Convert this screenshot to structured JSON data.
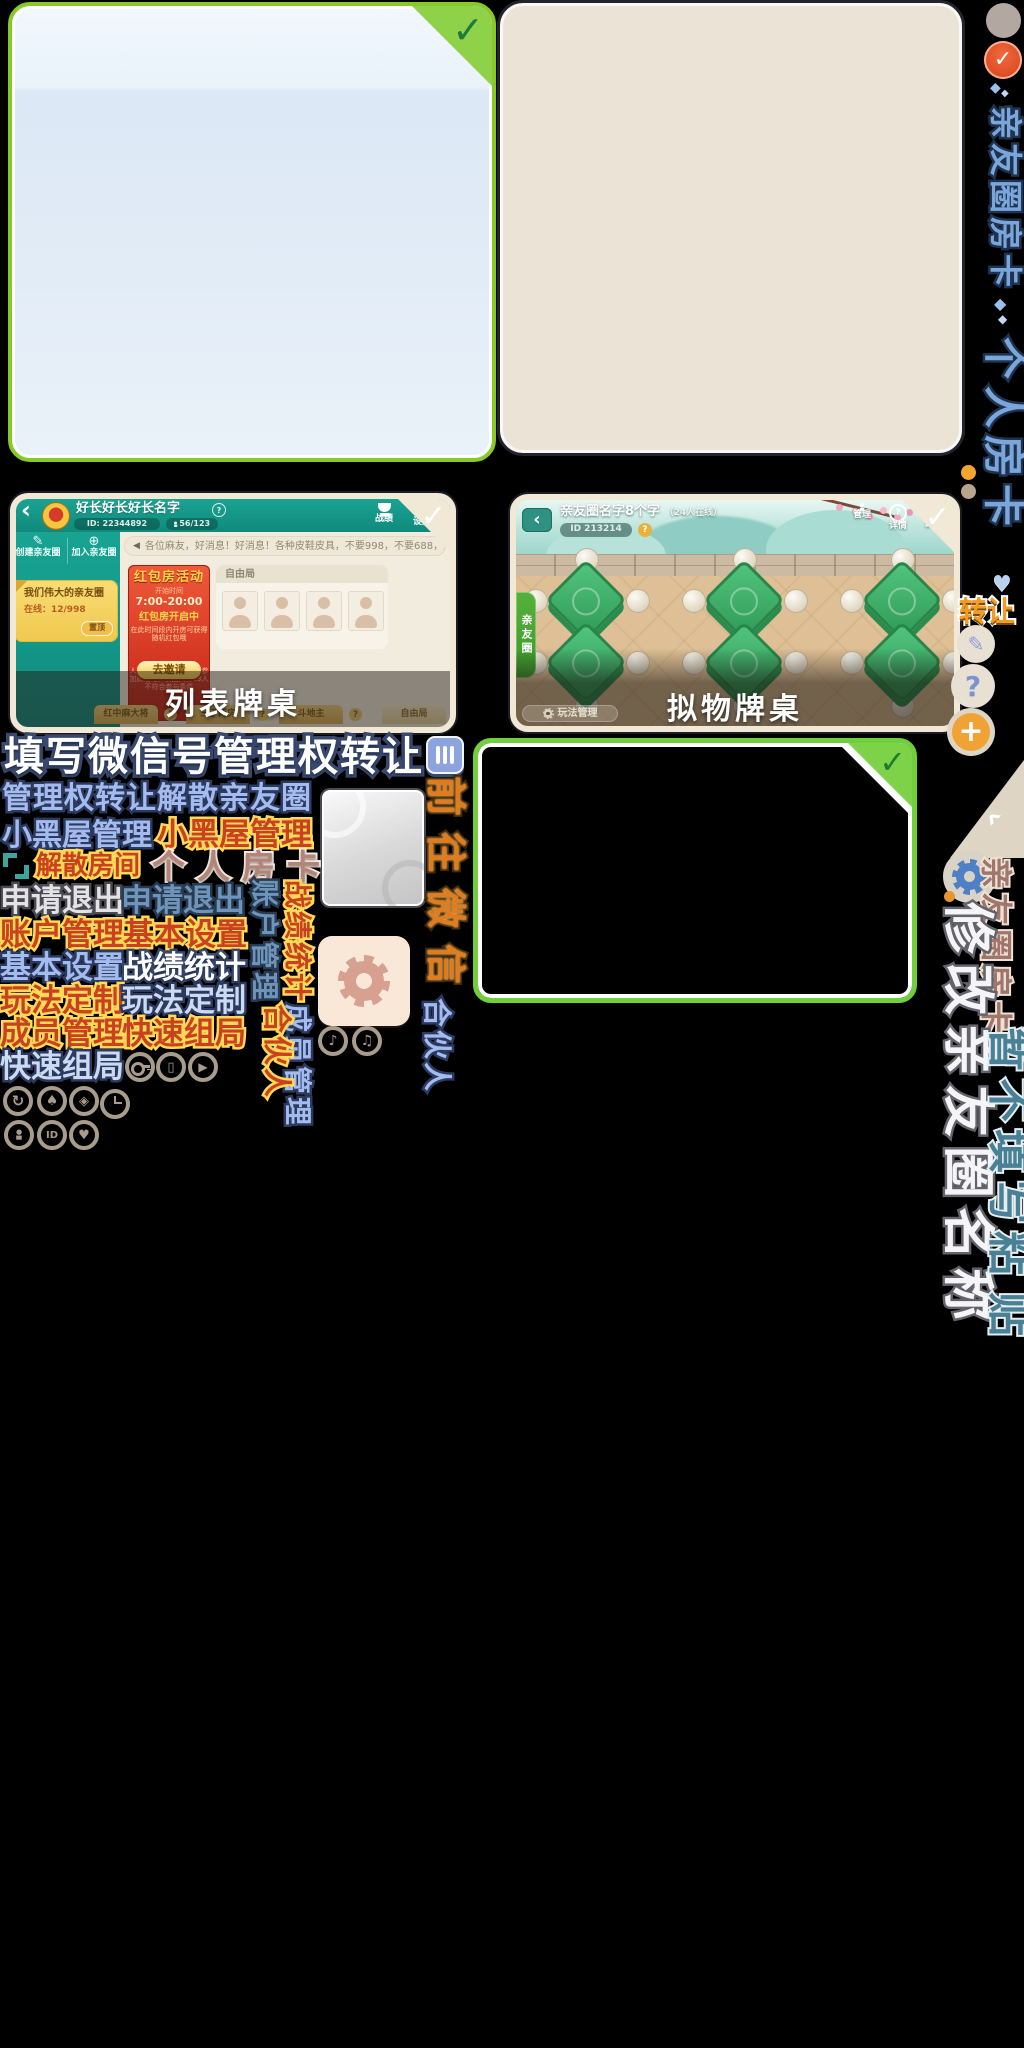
{
  "icons": {
    "check": "✓",
    "back": "‹",
    "question": "?",
    "plus": "+",
    "play": "▶",
    "heart": "♥",
    "eye": "◈",
    "spade": "♠",
    "share": "↻",
    "card": "▯",
    "id_text": "ID",
    "note": "♪",
    "note2": "♫",
    "speaker": "◀",
    "diamond": "◆",
    "chevron": "‹",
    "pencil": "✎",
    "head": "●",
    "body": "▄"
  },
  "list": {
    "title": "好长好长好长名字",
    "id_label": "ID: 22344892",
    "members": "56/123",
    "battle": "战绩",
    "settings": "设置",
    "message": "消息",
    "create": "创建亲友圈",
    "join": "加入亲友圈",
    "circle_name": "我们伟大的亲友圈",
    "online": "在线：12/998",
    "pin": "置顶",
    "announcement": "各位麻友，好消息！好消息！各种皮鞋皮具，不要998，不要688，只要98元，只…",
    "banner_title": "红包房活动",
    "banner_time_label": "开始时间",
    "banner_time": "7:00-20:00",
    "banner_status": "红包房开启中",
    "banner_desc1": "在此时间段内开房可获得",
    "banner_desc2": "随机红包哦",
    "banner_btn": "去邀请",
    "banner_note1": "人数满20人的亲友圈可参",
    "banner_note2": "加此活动，该圈只有13人",
    "banner_note3": "不符合参与条件",
    "free_mode": "自由局",
    "caption": "列表牌桌",
    "tabs": [
      "红中麻大将",
      "三丁两房",
      "斗地主",
      "自由局"
    ]
  },
  "room": {
    "title": "亲友圈名字8个字",
    "online": "（24人在线）",
    "id_label": "ID 213214",
    "manage": "管理",
    "detail": "详情",
    "battle": "战绩",
    "side_tab": "亲友圈",
    "caption": "拟物牌桌",
    "play_manage": "玩法管理"
  },
  "labels": {
    "fill_wechat": "填写微信号管理权转让",
    "transfer_dissolve": "管理权转让解散亲友圈",
    "blackroom_blue": "小黑屋管理",
    "blackroom_orange": "小黑屋管理",
    "dissolve_room": "解散房间",
    "personal_card_brown": "个人房卡",
    "apply_quit_white": "申请退出",
    "apply_quit_blue": "申请退出",
    "account_red": "账户管理",
    "basic_red": "基本设置",
    "basic_blue": "基本设置",
    "stats_white": "战绩统计",
    "custom_red": "玩法定制",
    "custom_blue": "玩法定制",
    "member_red": "成员管理",
    "quick_red": "快速组局",
    "quick_blue": "快速组局",
    "account_rot": "账户管理",
    "stats_rot": "战绩统计",
    "member_rot": "成员管理",
    "partner_orange": "合伙人",
    "partner_blue": "合伙人",
    "goto_wechat": "前往微信"
  },
  "rail": {
    "circle_card_blue": "亲友圈房卡",
    "personal_card_blue": "个人房卡",
    "transfer": "转让",
    "circle_card_brown": "亲友圈房卡",
    "modify_name": "修改亲友圈名称",
    "skip_fill_col1": "暂不填写粘",
    "skip_fill_col2": "贴"
  }
}
